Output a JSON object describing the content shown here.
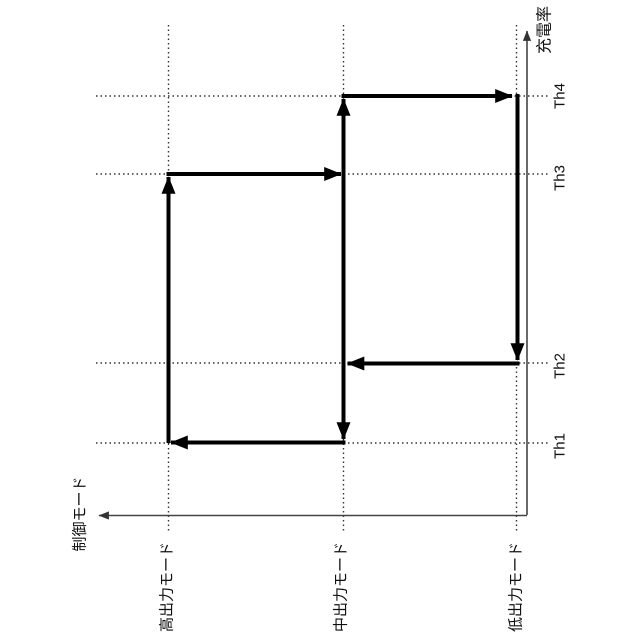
{
  "figure": {
    "type": "hysteresis-mode-transition-diagram",
    "y_axis_label": "充電率",
    "x_axis_label": "制御モード",
    "thresholds": [
      {
        "label": "Th1"
      },
      {
        "label": "Th2"
      },
      {
        "label": "Th3"
      },
      {
        "label": "Th4"
      }
    ],
    "modes": [
      {
        "label": "高出力モード"
      },
      {
        "label": "中出力モード"
      },
      {
        "label": "低出力モード"
      }
    ],
    "transitions": [
      {
        "from": "高出力モード",
        "to": "中出力モード",
        "at": "Th3",
        "charge_direction": "increasing"
      },
      {
        "from": "中出力モード",
        "to": "低出力モード",
        "at": "Th4",
        "charge_direction": "increasing"
      },
      {
        "from": "低出力モード",
        "to": "中出力モード",
        "at": "Th2",
        "charge_direction": "decreasing"
      },
      {
        "from": "中出力モード",
        "to": "高出力モード",
        "at": "Th1",
        "charge_direction": "decreasing"
      }
    ],
    "colors": {
      "path": "#000000",
      "axis": "#444444",
      "gridline": "#333333",
      "background": "#ffffff",
      "text": "#111111"
    }
  }
}
